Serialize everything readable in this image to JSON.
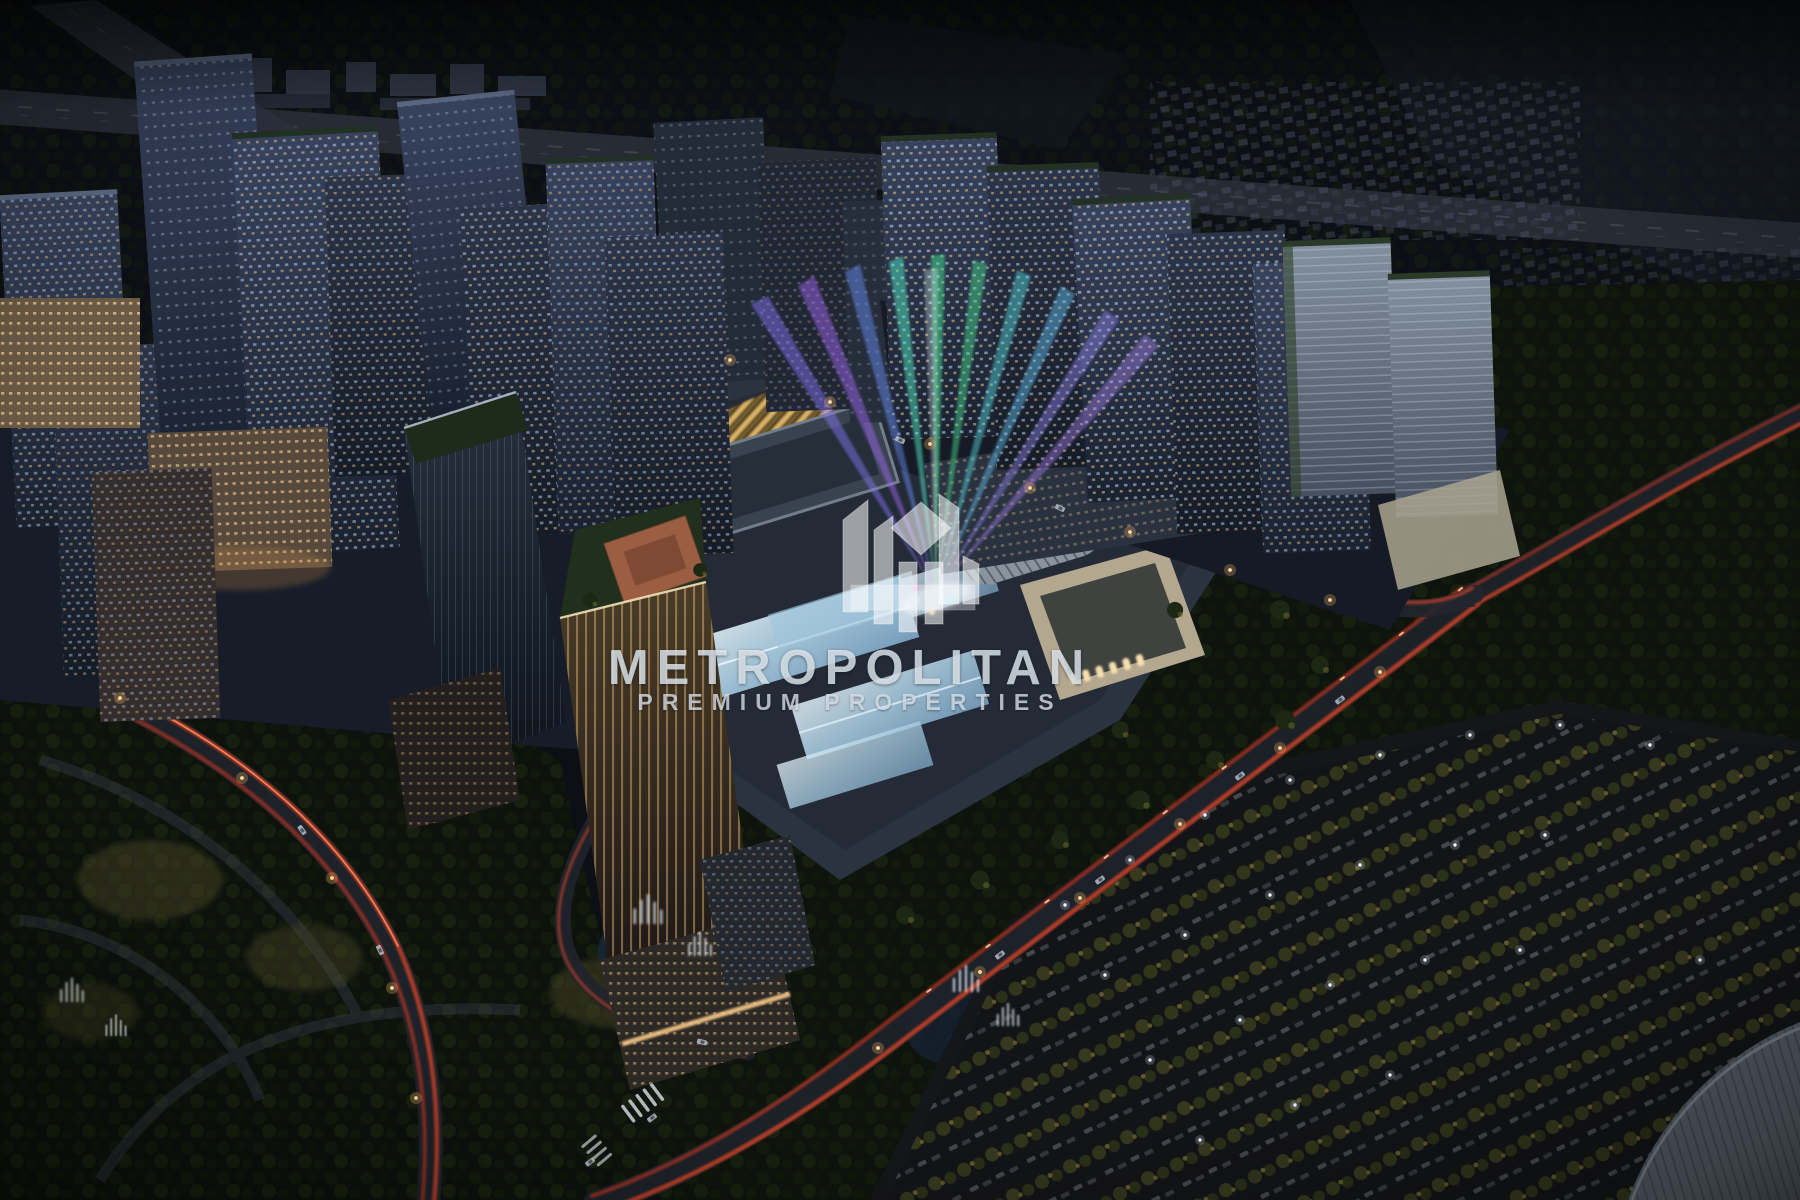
{
  "image": {
    "kind": "aerial-dusk-render",
    "description": "Aerial night rendering of a master-planned city district: illuminated residential towers, a central mall with glowing glass roofs and searchlight beams, roads with red car-light trails, a dark park with fountains at lower left and a tree-lined parking field at lower right.",
    "width_px": 1800,
    "height_px": 1200
  },
  "watermark": {
    "title": "METROPOLITAN",
    "subtitle": "PREMIUM PROPERTIES",
    "logo": "metropolitan-m-logo",
    "text_color": "#e6edf4"
  },
  "palette": {
    "sky_dark": "#0a0d13",
    "terrain_dark": "#0e130d",
    "tower_slate": "#2c3850",
    "tower_light": "#8d98a8",
    "window_warm": "#f0cd92",
    "window_cool": "#d7e4f4",
    "gold_facade": "#d9af5e",
    "glass_roof": "#cfe8f4",
    "road_trail_red": "#e8472b",
    "headlight": "#ffe2b0",
    "beam_cyan": "#49e0c8",
    "beam_green": "#44df90",
    "beam_blue": "#6a93ff",
    "beam_violet": "#a66bff",
    "fountain_white": "#e4edf5"
  }
}
